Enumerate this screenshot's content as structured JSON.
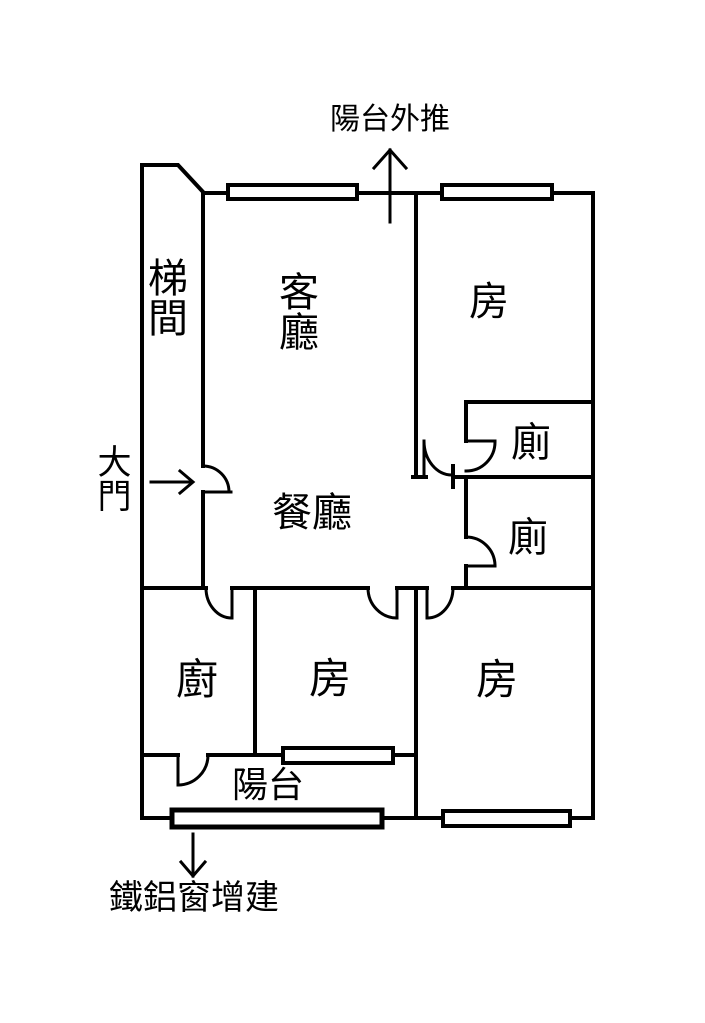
{
  "floorplan": {
    "annotations": {
      "balcony_pushout": "陽台外推",
      "entrance": "大門",
      "window_addition": "鐵鋁窗增建"
    },
    "rooms": {
      "stairwell": "梯間",
      "living": "客廳",
      "dining": "餐廳",
      "bedroom_top": "房",
      "bedroom_mid": "房",
      "bedroom_right": "房",
      "toilet_upper": "廁",
      "toilet_lower": "廁",
      "kitchen": "廚",
      "balcony": "陽台"
    },
    "colors": {
      "line": "#000000",
      "background": "#ffffff"
    }
  }
}
